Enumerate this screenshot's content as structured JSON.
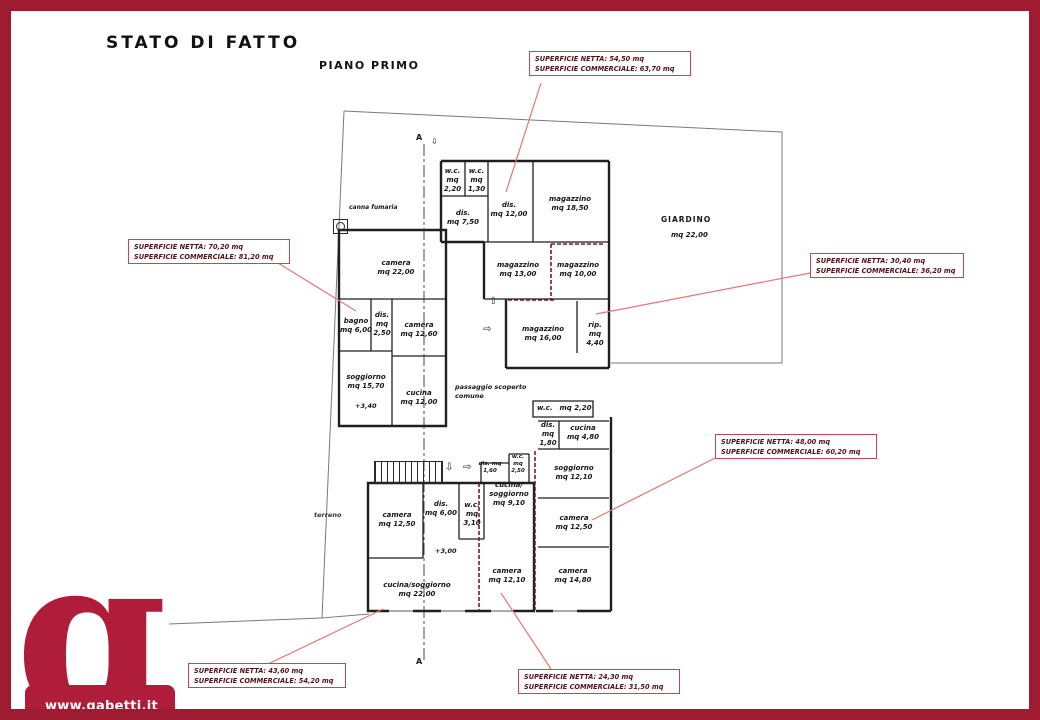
{
  "page": {
    "title": "STATO DI FATTO",
    "subtitle": "PIANO PRIMO"
  },
  "logo": {
    "letter": "g",
    "website": "www.gabetti.it"
  },
  "colors": {
    "frame": "#9e1b31",
    "logo": "#b01d3a",
    "annotation_border": "#c4455a",
    "leader": "#e87474",
    "demolition": "#7e1818"
  },
  "area_boxes": [
    {
      "line1": "SUPERFICIE NETTA: 54,50 mq",
      "line2": "SUPERFICIE COMMERCIALE: 63,70 mq"
    },
    {
      "line1": "SUPERFICIE NETTA: 70,20 mq",
      "line2": "SUPERFICIE COMMERCIALE: 81,20 mq"
    },
    {
      "line1": "SUPERFICIE NETTA: 30,40 mq",
      "line2": "SUPERFICIE COMMERCIALE: 36,20 mq"
    },
    {
      "line1": "SUPERFICIE NETTA: 48,00 mq",
      "line2": "SUPERFICIE COMMERCIALE: 60,20 mq"
    },
    {
      "line1": "SUPERFICIE NETTA: 43,60 mq",
      "line2": "SUPERFICIE COMMERCIALE: 54,20 mq"
    },
    {
      "line1": "SUPERFICIE NETTA: 24,30 mq",
      "line2": "SUPERFICIE COMMERCIALE: 31,50 mq"
    }
  ],
  "rooms": [
    {
      "lines": [
        "camera",
        "mq 22,00"
      ]
    },
    {
      "lines": [
        "bagno",
        "mq 6,00"
      ]
    },
    {
      "lines": [
        "dis.",
        "mq",
        "2,50"
      ]
    },
    {
      "lines": [
        "camera",
        "mq 12,60"
      ]
    },
    {
      "lines": [
        "soggiorno",
        "mq 15,70"
      ]
    },
    {
      "lines": [
        "cucina",
        "mq 12,00"
      ]
    },
    {
      "lines": [
        "w.c.",
        "mq",
        "2,20"
      ]
    },
    {
      "lines": [
        "w.c.",
        "mq",
        "1,30"
      ]
    },
    {
      "lines": [
        "dis.",
        "mq 7,50"
      ]
    },
    {
      "lines": [
        "dis.",
        "mq 12,00"
      ]
    },
    {
      "lines": [
        "magazzino",
        "mq 18,50"
      ]
    },
    {
      "lines": [
        "magazzino",
        "mq 13,00"
      ]
    },
    {
      "lines": [
        "magazzino",
        "mq 10,00"
      ]
    },
    {
      "lines": [
        "magazzino",
        "mq 16,00"
      ]
    },
    {
      "lines": [
        "rip.",
        "mq",
        "4,40"
      ]
    },
    {
      "lines": [
        "w.c.",
        "mq 2,20"
      ]
    },
    {
      "lines": [
        "dis.",
        "mq",
        "1,80"
      ]
    },
    {
      "lines": [
        "cucina",
        "mq 4,80"
      ]
    },
    {
      "lines": [
        "soggiorno",
        "mq 12,10"
      ]
    },
    {
      "lines": [
        "camera",
        "mq 12,50"
      ]
    },
    {
      "lines": [
        "camera",
        "mq 14,80"
      ]
    },
    {
      "lines": [
        "dis. mq",
        "1,60"
      ]
    },
    {
      "lines": [
        "w.c.",
        "mq",
        "2,50"
      ]
    },
    {
      "lines": [
        "camera",
        "mq 12,50"
      ]
    },
    {
      "lines": [
        "dis.",
        "mq 6,00"
      ]
    },
    {
      "lines": [
        "w.c.",
        "mq",
        "3,10"
      ]
    },
    {
      "lines": [
        "cucina/",
        "soggiorno",
        "mq 9,10"
      ]
    },
    {
      "lines": [
        "cucina/soggiorno",
        "mq 22,00"
      ]
    },
    {
      "lines": [
        "camera",
        "mq 12,10"
      ]
    }
  ],
  "labels": {
    "giardino": "GIARDINO",
    "giardino_mq": "mq 22,00",
    "passaggio_1": "passaggio scoperto",
    "passaggio_2": "comune",
    "canna_fumaria": "canna fumaria",
    "terreno": "terreno",
    "section": "A",
    "level_1": "+3,40",
    "level_2": "+3,00"
  },
  "icons": {
    "arrow_up": "⇧",
    "arrow_right": "⇨",
    "arrow_down": "⇩"
  }
}
